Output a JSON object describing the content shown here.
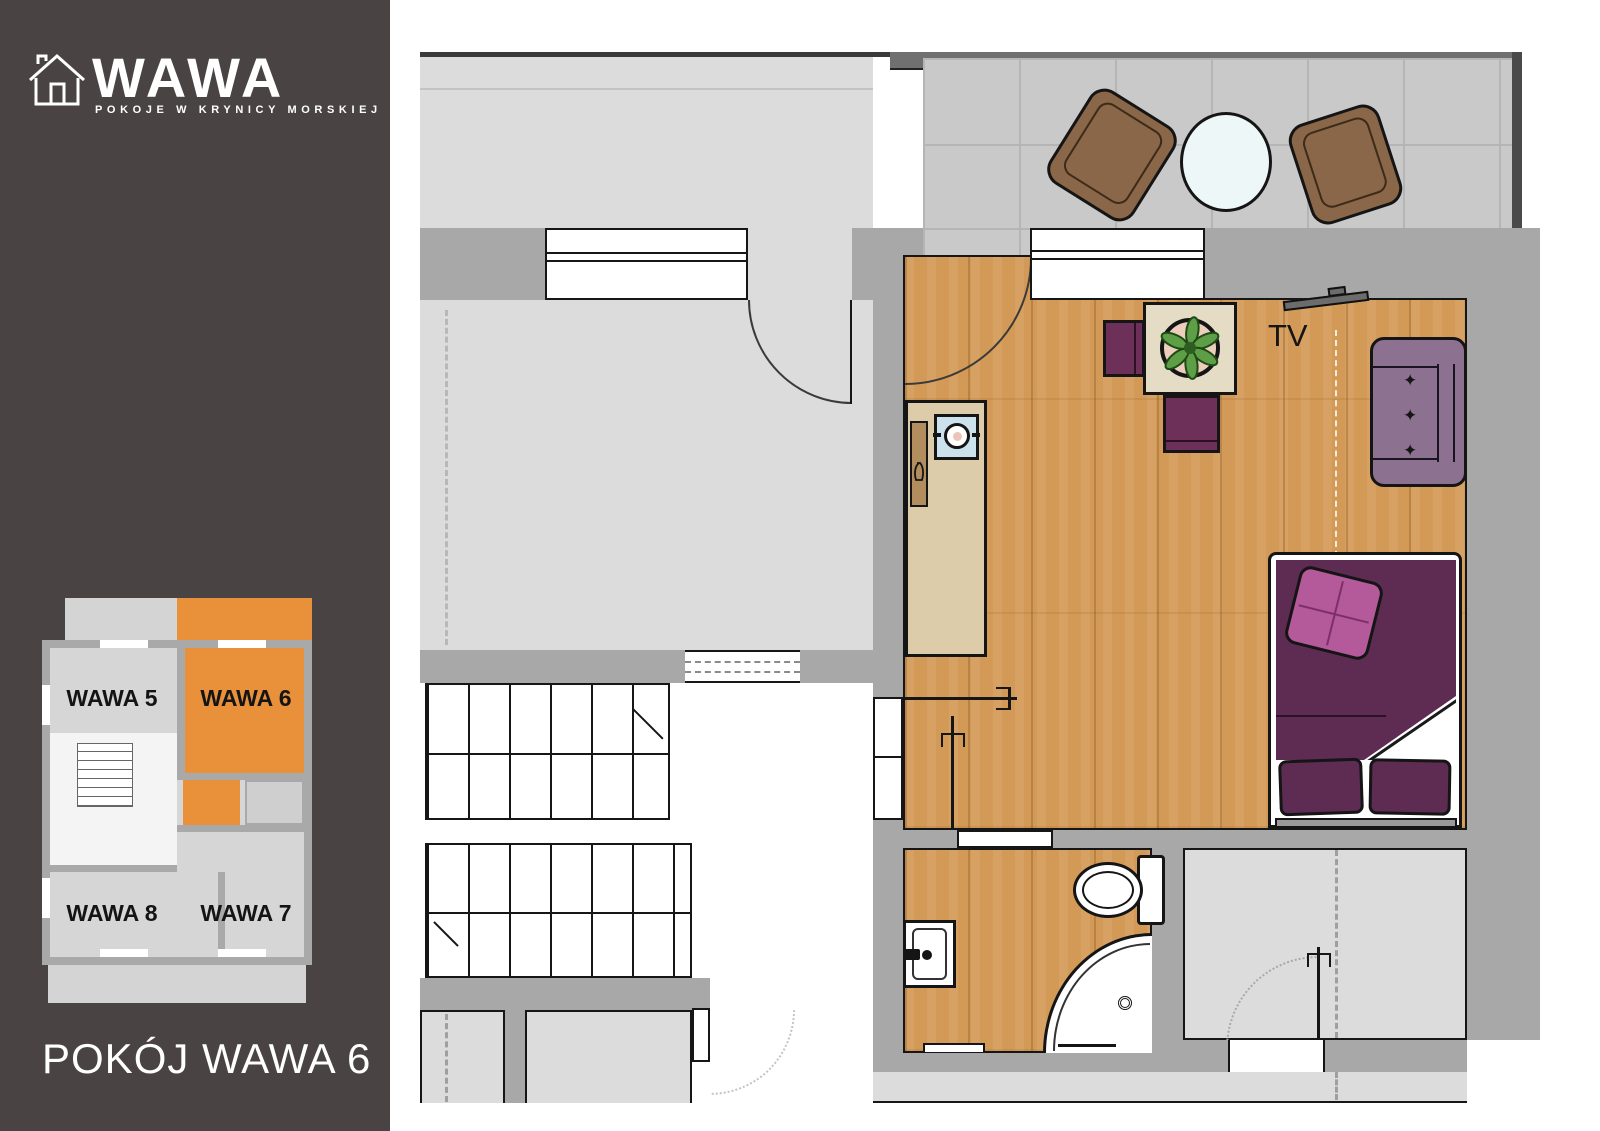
{
  "sidebar": {
    "brand": "WAWA",
    "tagline": "POKOJE W KRYNICY MORSKIEJ",
    "caption": "POKÓJ WAWA 6",
    "logo_icon": "house-outline-icon",
    "mini_plan": {
      "highlight_color": "#E8913A",
      "rooms": [
        {
          "label": "WAWA 5",
          "highlighted": false
        },
        {
          "label": "WAWA 6",
          "highlighted": true
        },
        {
          "label": "WAWA 8",
          "highlighted": false
        },
        {
          "label": "WAWA 7",
          "highlighted": false
        }
      ]
    }
  },
  "plan": {
    "labels": {
      "tv": "TV"
    },
    "icons": [
      "bed",
      "sofa",
      "tv",
      "dining-table",
      "plant",
      "chair",
      "kitchenette",
      "kitchen-sink",
      "toilet",
      "shower",
      "washbasin",
      "stairs",
      "balcony-chair",
      "balcony-table",
      "door-swing",
      "window",
      "sliding-door-handle"
    ],
    "colors": {
      "wall": "#A8A8A8",
      "floor_light": "#DCDCDC",
      "wood": "#D39A57",
      "tile": "#C9C9C9",
      "bed": "#5E2B52",
      "pillow_accent": "#B4599A",
      "sofa": "#8D7191",
      "chair": "#6D3058",
      "table": "#E5DCC6",
      "balcony_chair": "#8A6748",
      "highlight": "#E8913A"
    }
  }
}
